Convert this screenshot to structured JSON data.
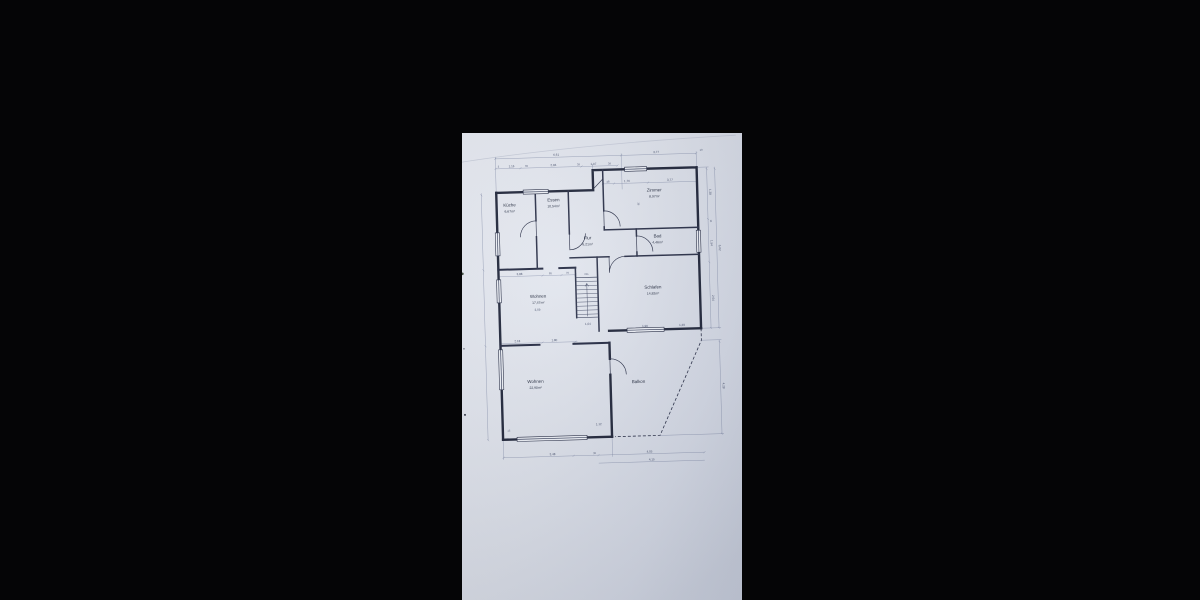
{
  "scene": {
    "background": "#050506",
    "paper_tint": "#dfe3ec"
  },
  "floorplan": {
    "rooms": [
      {
        "name": "Küche",
        "area": "6,67m²"
      },
      {
        "name": "Essen",
        "area": "10,54m²"
      },
      {
        "name": "Zimmer",
        "area": "8,97m²"
      },
      {
        "name": "Flur",
        "area": "6,21m²"
      },
      {
        "name": "Bad",
        "area": "4,46m²"
      },
      {
        "name": "Wohnen",
        "area": "17,47m²"
      },
      {
        "name": "Schlafen",
        "area": "14,82m²"
      },
      {
        "name": "Wohnen",
        "area": "22,90m²"
      },
      {
        "name": "Balkon",
        "area": ""
      }
    ],
    "stairs": {
      "label": "OG",
      "width": "1,04"
    },
    "dims": {
      "top1": [
        "6,61",
        "3,77",
        "10"
      ],
      "top2": [
        "3",
        "1,16",
        "39",
        "2,84",
        "39",
        "1,07",
        "39"
      ],
      "zimmer": [
        "48",
        "1,76",
        "3,77",
        "36"
      ],
      "right": [
        "1,38",
        "11",
        "1,54",
        "6,02",
        "2,64",
        "4,28"
      ],
      "bottom": [
        "3,48",
        "39",
        "4,05",
        "4,15",
        "15"
      ],
      "wohnen_top": [
        "2,18",
        "1,80"
      ],
      "balkon": [
        "1,90",
        "1,29",
        "1,12"
      ],
      "flur_chain": [
        "3,88",
        "85",
        "76"
      ],
      "wohnen_mid": [
        "3,59"
      ]
    }
  }
}
